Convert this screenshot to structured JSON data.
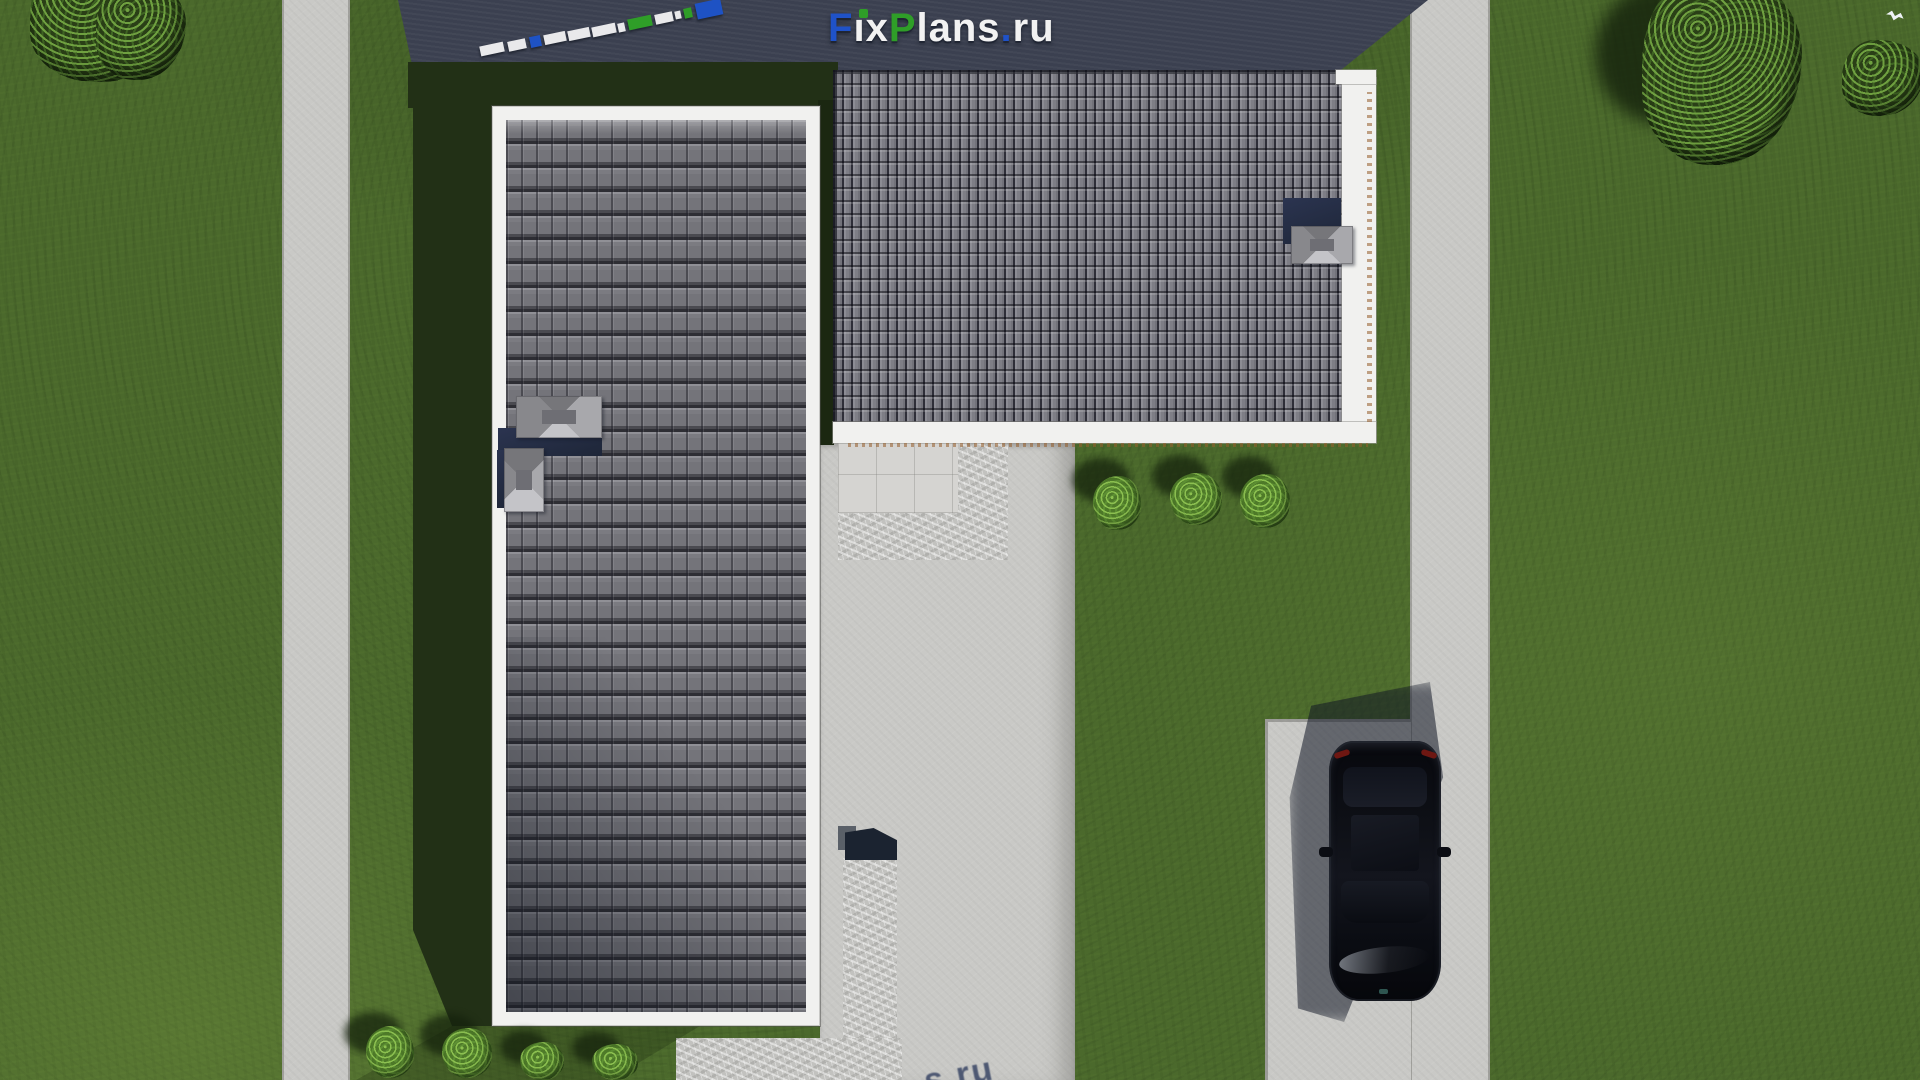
{
  "brand": {
    "logo": {
      "f": "F",
      "i_dotless": "ı",
      "x": "x",
      "p": "P",
      "lans": "lans",
      "dot": ".",
      "ru": "ru"
    },
    "full_name": "FixPlans.ru",
    "colors": {
      "blue": "#1f52c8",
      "green": "#2f9e28",
      "white": "#f2f2f2"
    }
  },
  "bottom_watermark": {
    "text": "s.ru"
  },
  "scene": {
    "description": "aerial top-down 3D render of an L-shaped house site plan",
    "objects": [
      "lawn",
      "left-footpath",
      "right-road",
      "left-roof-wing",
      "right-roof-wing",
      "roof-skylights",
      "courtyard-driveway",
      "paver-patio",
      "paver-walkway",
      "parking-pad",
      "black-car",
      "garden-bushes",
      "trees"
    ]
  }
}
